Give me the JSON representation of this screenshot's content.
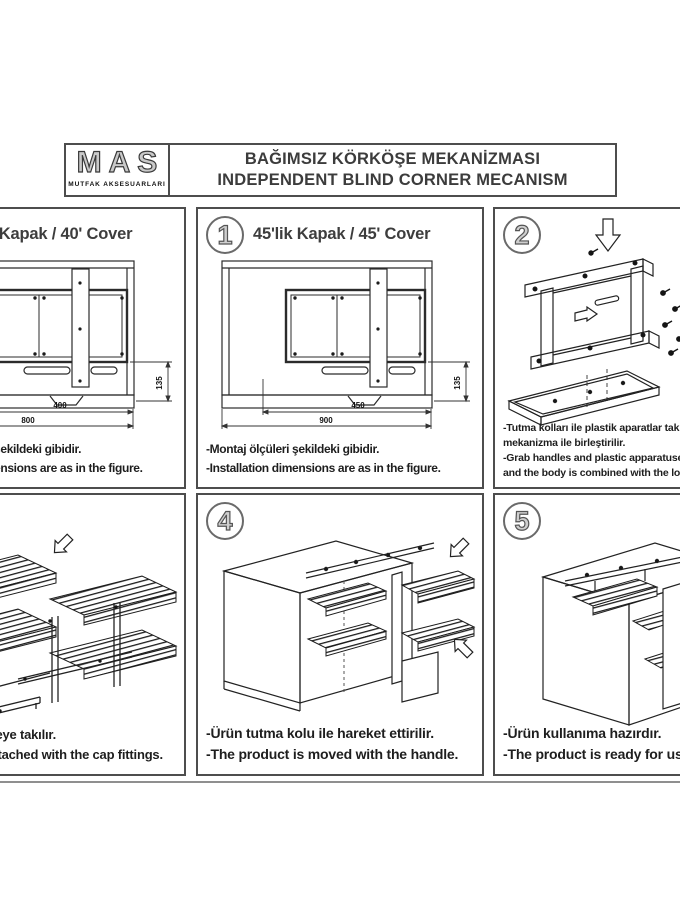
{
  "header": {
    "logo_brand": "MAS",
    "logo_subtitle": "MUTFAK AKSESUARLARI",
    "title_tr": "BAĞIMSIZ KÖRKÖŞE MEKANİZMASI",
    "title_en": "INDEPENDENT BLIND CORNER MECANISM"
  },
  "panels": [
    {
      "id": "cover-40",
      "title": "40'lik Kapak / 40' Cover",
      "dims": {
        "inner": "400",
        "outer": "800",
        "height": "135"
      },
      "caption_tr": "-Montaj ölçüleri şekildeki gibidir.",
      "caption_en": "-Installation dimensions are as in the figure."
    },
    {
      "id": "cover-45",
      "number": "1",
      "title": "45'lik Kapak / 45' Cover",
      "dims": {
        "inner": "450",
        "outer": "900",
        "height": "135"
      },
      "caption_tr": "-Montaj ölçüleri şekildeki gibidir.",
      "caption_en": "-Installation dimensions are as in the figure."
    },
    {
      "id": "step-2",
      "number": "2",
      "caption_tr_1": "-Tutma kolları ile plastik aparatlar takılır, alt",
      "caption_tr_2": "mekanizma ile birleştirilir.",
      "caption_en_1": "-Grab handles and plastic apparatuses are attached",
      "caption_en_2": "and the body is combined with the lower mechanism."
    },
    {
      "id": "step-3",
      "caption_tr": "-Sepetler gövdeye takılır.",
      "caption_en": "-Baskets are attached with the cap fittings."
    },
    {
      "id": "step-4",
      "number": "4",
      "caption_tr": "-Ürün tutma kolu ile hareket ettirilir.",
      "caption_en": "-The product is moved with the handle."
    },
    {
      "id": "step-5",
      "number": "5",
      "caption_tr": "-Ürün kullanıma hazırdır.",
      "caption_en": "-The product is ready for use."
    }
  ],
  "colors": {
    "line": "#2b2b2b",
    "panel_border": "#4d4d4d",
    "text": "#1e1e1e"
  }
}
